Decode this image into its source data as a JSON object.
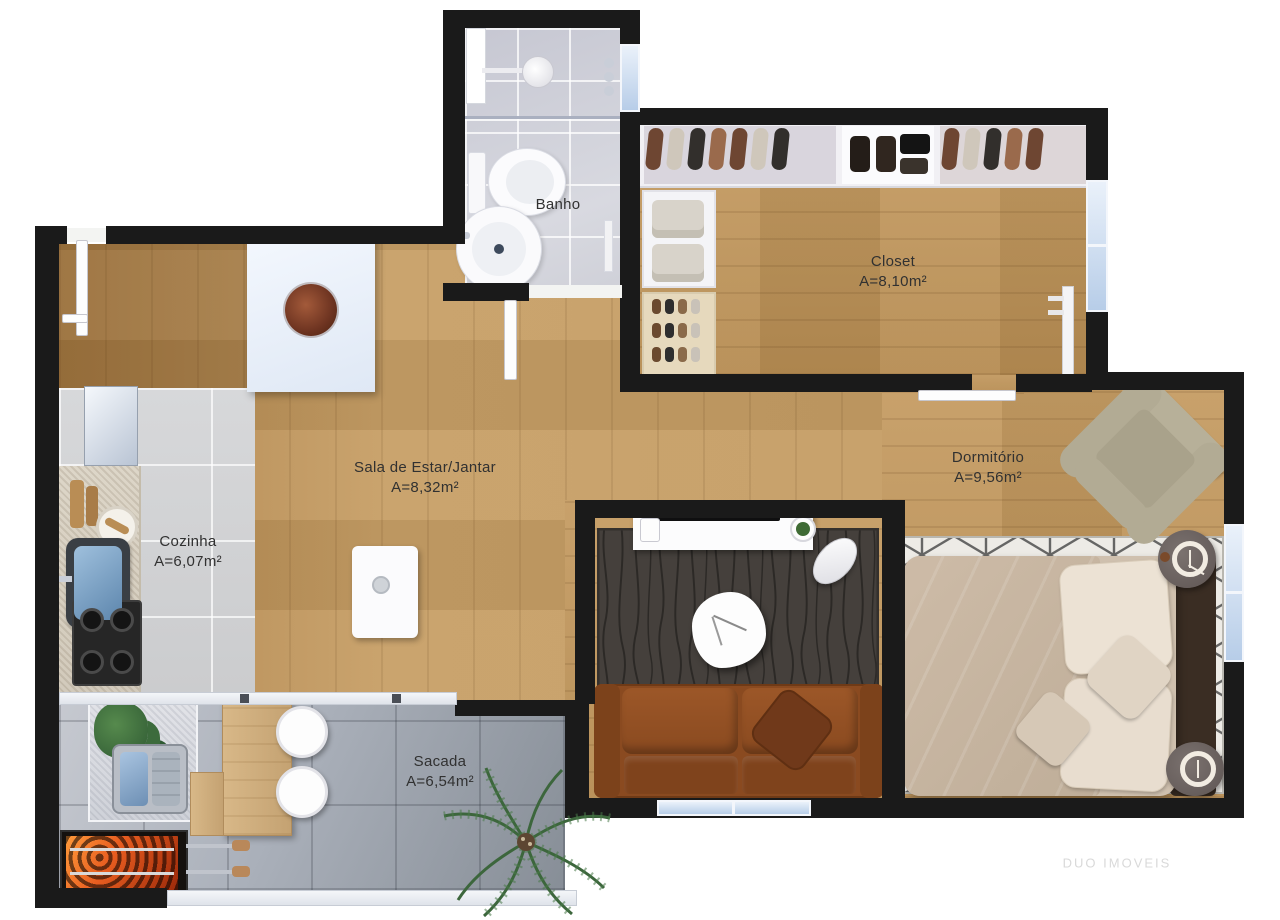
{
  "plan": {
    "watermark": "DUO IMOVEIS",
    "rooms": [
      {
        "id": "banho",
        "label": "Banho",
        "area": ""
      },
      {
        "id": "closet",
        "label": "Closet",
        "area": "A=8,10m²"
      },
      {
        "id": "sala",
        "label": "Sala de Estar/Jantar",
        "area": "A=8,32m²"
      },
      {
        "id": "dormitorio",
        "label": "Dormitório",
        "area": "A=9,56m²"
      },
      {
        "id": "cozinha",
        "label": "Cozinha",
        "area": "A=6,07m²"
      },
      {
        "id": "sacada",
        "label": "Sacada",
        "area": "A=6,54m²"
      }
    ],
    "colors": {
      "wall": "#1a1a1a",
      "wood_floor": "#c49a62",
      "kitchen_tile": "#d2d3d5",
      "balcony_tile": "#a8adb6",
      "bath_tile": "#cdced8",
      "window_glass": "#cfe0f2",
      "living_rug": "#45403c",
      "bedroom_rug": "#ebe9e4",
      "sofa_leather": "#8a4a20",
      "bed_linen": "#c6b4a0",
      "grill_ember": "#e85d20"
    }
  }
}
